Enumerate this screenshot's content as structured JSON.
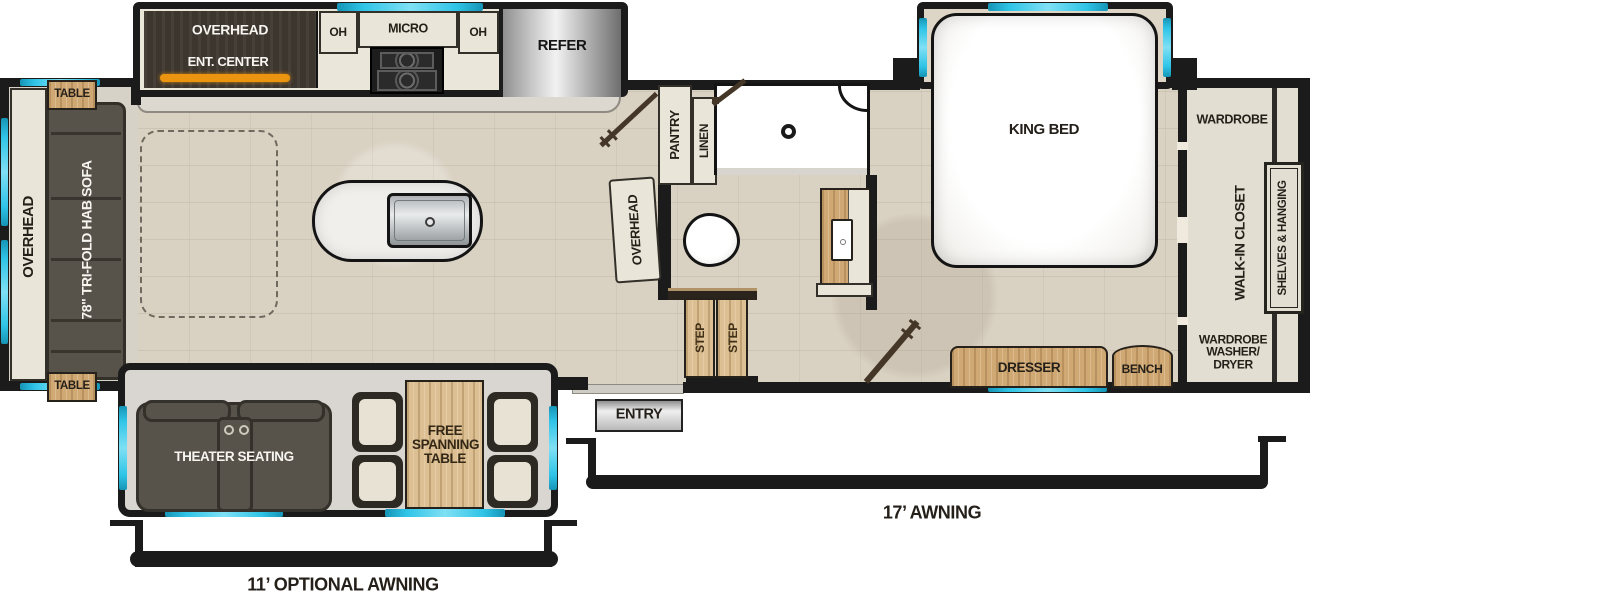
{
  "plan_title": "fifth-wheel RV floorplan",
  "colors": {
    "wall": "#1b1b1b",
    "floor_tile": "#d9d1c2",
    "cabinet_cream": "#e9e5d8",
    "closet_cream": "#e2ded1",
    "wood": "#cfa873",
    "dark_cabinet": "#3d362e",
    "accent_orange": "#ea940f",
    "window_cyan": "#2fc4e7",
    "sofa_gray": "#57524a"
  },
  "rear": {
    "overhead": "OVERHEAD",
    "sofa": "78\" TRI-FOLD HAB SOFA",
    "table_top": "TABLE",
    "table_bottom": "TABLE"
  },
  "kitchen_slide": {
    "overhead": "OVERHEAD",
    "ent_center": "ENT. CENTER",
    "oh_left": "OH",
    "micro": "MICRO",
    "oh_right": "OH",
    "refer": "REFER"
  },
  "bath": {
    "pantry": "PANTRY",
    "linen": "LINEN",
    "overhead": "OVERHEAD",
    "step_1": "STEP",
    "step_2": "STEP"
  },
  "bedroom": {
    "king_bed": "KING BED",
    "dresser": "DRESSER",
    "bench": "BENCH"
  },
  "closet": {
    "wardrobe": "WARDROBE",
    "walk_in": "WALK-IN CLOSET",
    "shelves_hanging": "SHELVES & HANGING",
    "washer_line1": "WARDROBE",
    "washer_line2": "WASHER/",
    "washer_line3": "DRYER"
  },
  "bottom_slide": {
    "theater": "THEATER SEATING",
    "table": "FREE SPANNING TABLE"
  },
  "entry": {
    "label": "ENTRY"
  },
  "awnings": {
    "main": "17’ AWNING",
    "optional": "11’ OPTIONAL AWNING"
  }
}
